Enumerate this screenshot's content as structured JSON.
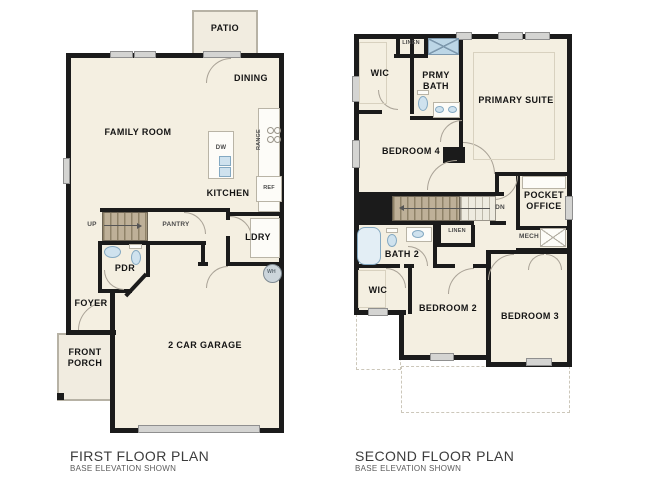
{
  "colors": {
    "wall": "#1b1b1b",
    "floor": "#f4efe1",
    "outdoor": "#f1ece0",
    "fixture_blue": "#cfe2ee",
    "stair_tan": "#b3a488",
    "caption_text": "#3c3c3c"
  },
  "first_floor": {
    "caption": {
      "title": "FIRST FLOOR PLAN",
      "subtitle": "BASE ELEVATION SHOWN"
    },
    "rooms": {
      "patio": "PATIO",
      "dining": "DINING",
      "family_room": "FAMILY ROOM",
      "kitchen": "KITCHEN",
      "pantry": "PANTRY",
      "ldry": "LDRY",
      "pdr": "PDR",
      "foyer": "FOYER",
      "front_porch": "FRONT\nPORCH",
      "garage": "2 CAR GARAGE"
    },
    "fixtures": {
      "dw": "DW",
      "range": "RANGE",
      "ref": "REF",
      "wh": "WH"
    },
    "stairs": {
      "direction": "UP"
    }
  },
  "second_floor": {
    "caption": {
      "title": "SECOND FLOOR PLAN",
      "subtitle": "BASE ELEVATION SHOWN"
    },
    "rooms": {
      "wic_primary": "WIC",
      "linen_upper": "LINEN",
      "primary_bath": "PRMY\nBATH",
      "primary_suite": "PRIMARY SUITE",
      "bedroom_4": "BEDROOM 4",
      "pocket_office": "POCKET\nOFFICE",
      "linen_hall": "LINEN",
      "mech": "MECH",
      "bath_2": "BATH 2",
      "wic_bedroom2": "WIC",
      "bedroom_2": "BEDROOM 2",
      "bedroom_3": "BEDROOM 3"
    },
    "stairs": {
      "direction": "DN"
    }
  }
}
